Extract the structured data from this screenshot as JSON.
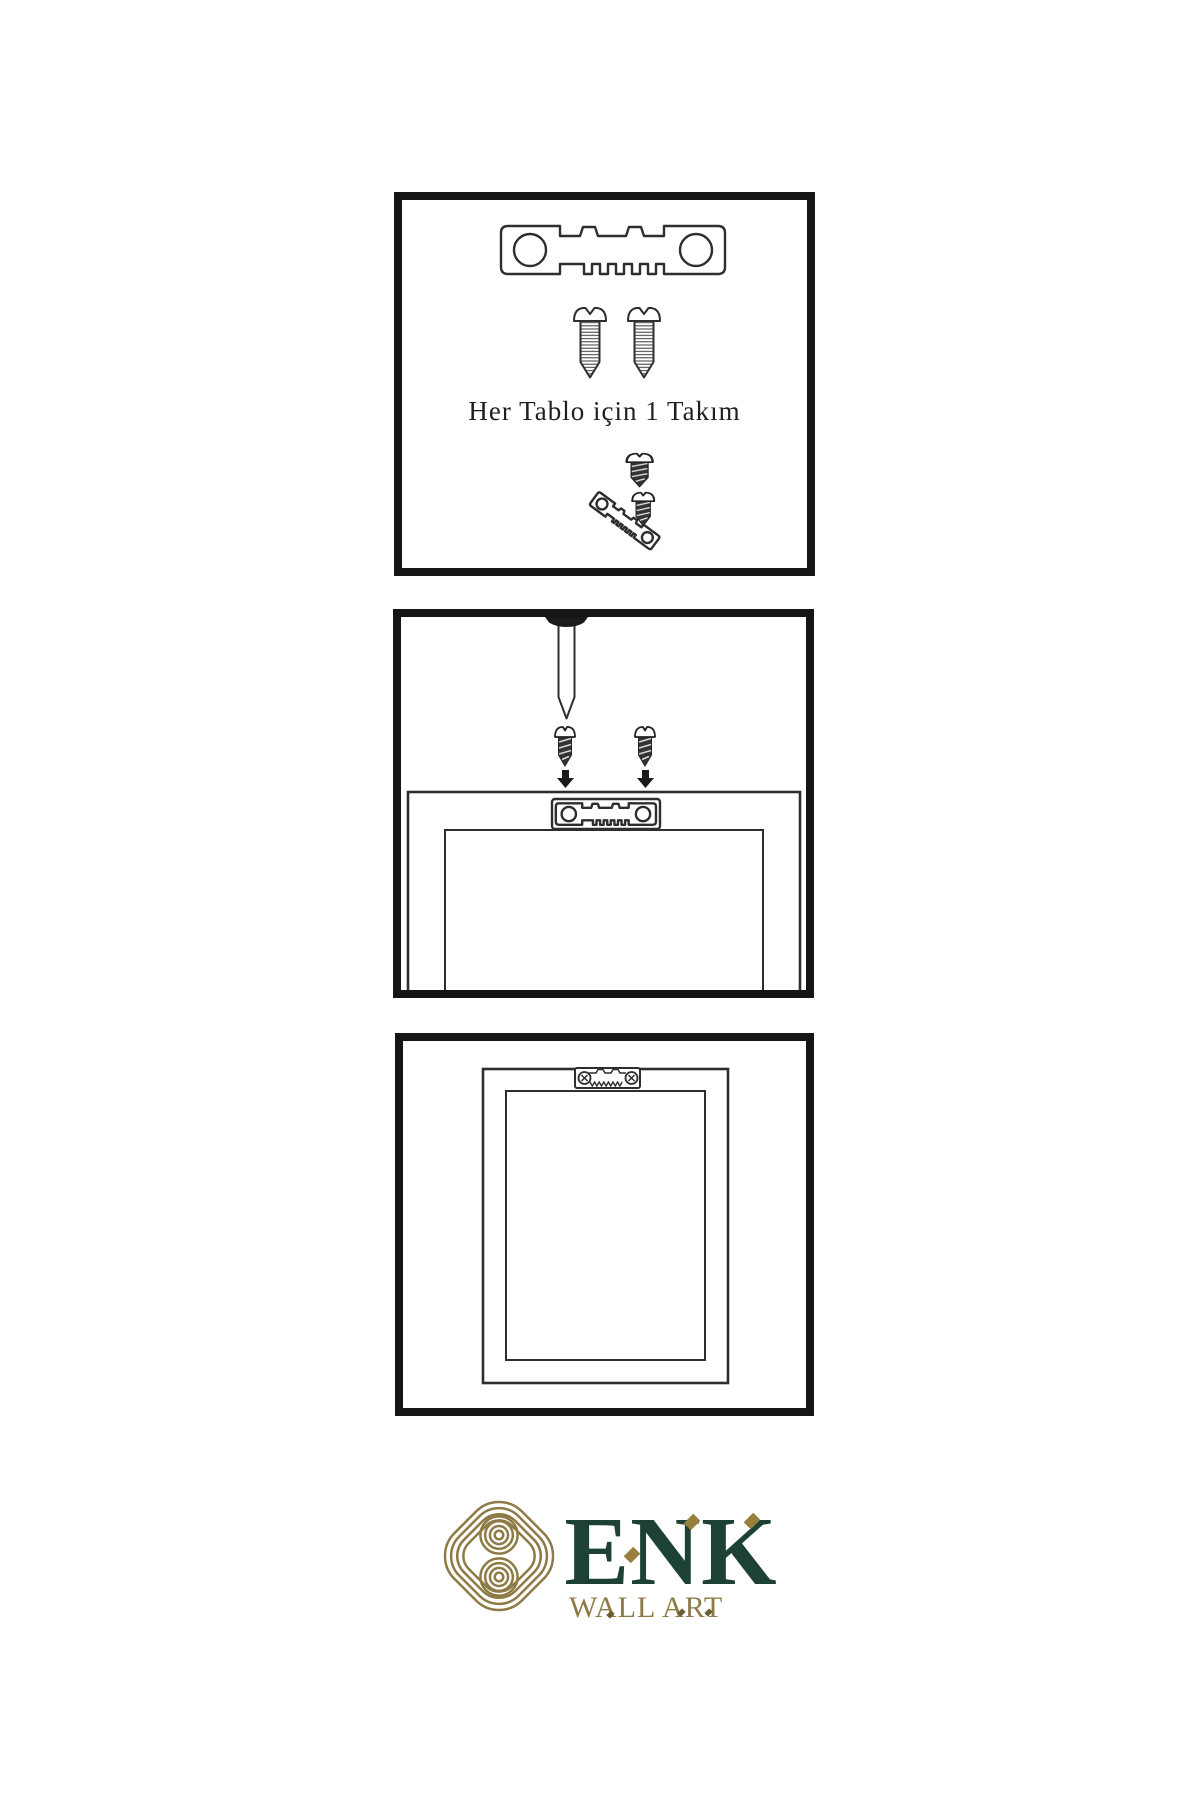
{
  "panels": [
    {
      "id": "kit",
      "caption": "Her Tablo için 1 Takım"
    },
    {
      "id": "mount"
    },
    {
      "id": "hang"
    }
  ],
  "brand": {
    "name": "ENK",
    "subtitle": "WALL ART"
  },
  "colors": {
    "panel_border": "#151515",
    "line_ink": "#2e2e2e",
    "hardware_dark": "#333333",
    "brand_green": "#1d4134",
    "brand_gold": "#8d7a45",
    "accent_gold": "#97803d"
  },
  "icons": {
    "logo": "knot-icon",
    "hardware": [
      "sawtooth-hanger-icon",
      "screw-icon",
      "dark-screw-icon",
      "nail-icon",
      "arrow-down-icon",
      "frame-back-icon",
      "frame-front-icon"
    ]
  }
}
